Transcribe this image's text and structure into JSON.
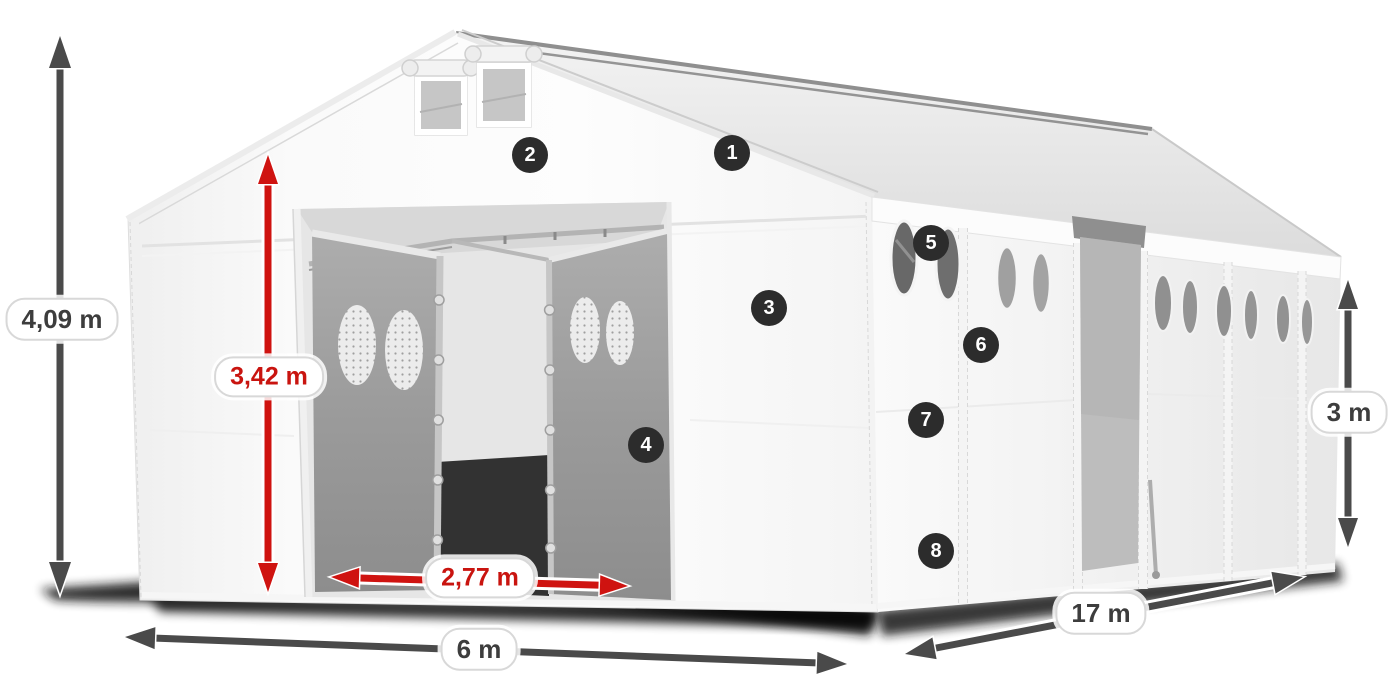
{
  "diagram": {
    "badges": [
      "1",
      "2",
      "3",
      "4",
      "5",
      "6",
      "7",
      "8"
    ],
    "dimensions": {
      "total_height": "4,09 m",
      "entrance_height": "3,42 m",
      "entrance_width": "2,77 m",
      "width": "6 m",
      "length": "17 m",
      "side_height": "3 m"
    },
    "colors": {
      "arrow_gray": "#4a4a4a",
      "arrow_red": "#cf1310",
      "label_text_gray": "#3d3d3d",
      "label_text_red": "#c9140f",
      "badge_background": "#2c2c2c",
      "badge_text": "#ffffff",
      "tent_white": "#f8f8f8",
      "inner_panel_gray": "#9a9a9a"
    }
  }
}
